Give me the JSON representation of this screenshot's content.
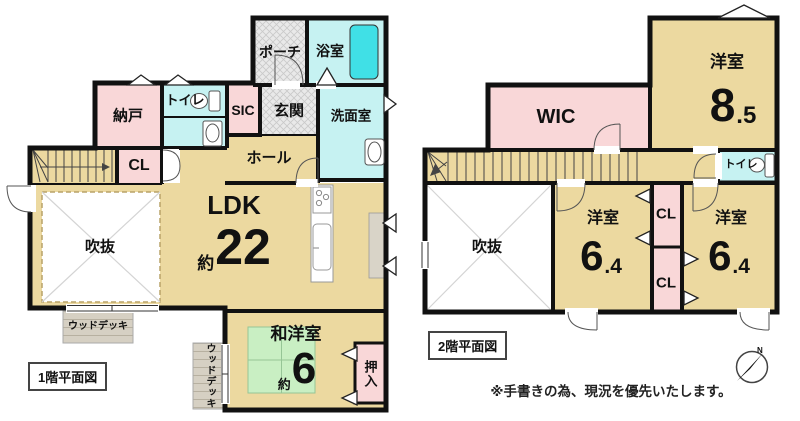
{
  "colors": {
    "tan": "#ecd9a0",
    "pink": "#f9d7d8",
    "cyan": "#c6f2f2",
    "tub": "#40e0e6",
    "tatami": "#c9efc3",
    "deck": "#d6d0c3",
    "hatch": "#e9e9e9",
    "counter": "#d9d4c8",
    "wall": "#111111",
    "white": "#ffffff"
  },
  "floor1": {
    "title": "1階平面図",
    "rooms": {
      "nando": "納戸",
      "toilet": "トイレ",
      "sic": "SIC",
      "porch": "ポーチ",
      "bath": "浴室",
      "genkan": "玄関",
      "senmen": "洗面室",
      "cl": "CL",
      "hall": "ホール",
      "ldk": {
        "label": "LDK",
        "approx": "約",
        "area": "22"
      },
      "fukinuke": "吹抜",
      "washitsu": {
        "label": "和洋室",
        "approx": "約",
        "area": "6"
      },
      "oshiire": "押入",
      "wooddeck_south": "ウッドデッキ",
      "wooddeck_east": "ウッドデッキ"
    }
  },
  "floor2": {
    "title": "2階平面図",
    "rooms": {
      "wic": "WIC",
      "main_bedroom": {
        "label": "洋室",
        "area": "8",
        "frac": ".5"
      },
      "toilet": "トイレ",
      "fukinuke": "吹抜",
      "bedroom_west": {
        "label": "洋室",
        "area": "6",
        "frac": ".4"
      },
      "bedroom_east": {
        "label": "洋室",
        "area": "6",
        "frac": ".4"
      },
      "cl_north": "CL",
      "cl_south": "CL"
    }
  },
  "note": "※手書きの為、現況を優先いたします。",
  "compass": {
    "north": "N"
  }
}
